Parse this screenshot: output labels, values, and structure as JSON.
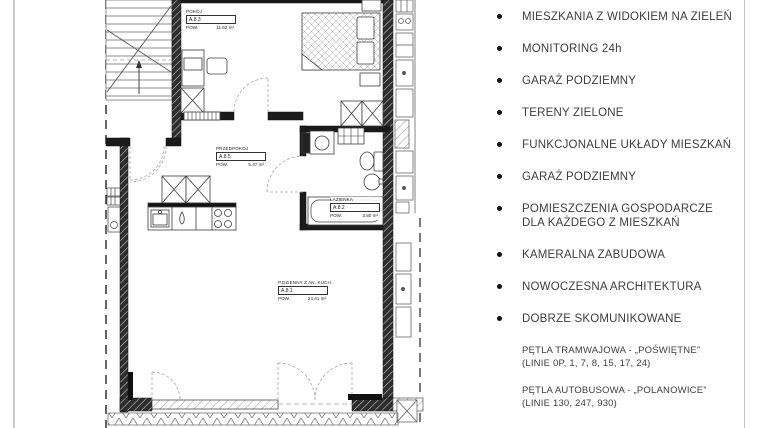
{
  "page": {
    "background": "#ffffff",
    "divider_color": "#c4c4c4",
    "wall_color": "#1b1b1b"
  },
  "floor_plan": {
    "rooms": [
      {
        "name": "POKÓJ",
        "code": "A.8.3",
        "area_label": "POW.",
        "area": "11.62 m²"
      },
      {
        "name": "PRZEDPOKÓJ",
        "code": "A.8.5",
        "area_label": "POW.",
        "area": "5.47 m²"
      },
      {
        "name": "ŁAZIENKA",
        "code": "A.8.2",
        "area_label": "POW.",
        "area": "3.80 m²"
      },
      {
        "name": "P.DZIENNY Z AN. KUCH.",
        "code": "A.8.1",
        "area_label": "POW.",
        "area": "24.41 m²"
      }
    ]
  },
  "features": {
    "items": [
      {
        "label": "MIESZKANIA Z WIDOKIEM NA ZIELEŃ"
      },
      {
        "label": "MONITORING 24h"
      },
      {
        "label": "GARAŻ PODZIEMNY"
      },
      {
        "label": "TERENY ZIELONE"
      },
      {
        "label": "FUNKCJONALNE UKŁADY MIESZKAŃ"
      },
      {
        "label": "GARAŻ PODZIEMNY"
      },
      {
        "label": "POMIESZCZENIA GOSPODARCZE",
        "label2": "DLA KAŻDEGO Z MIESZKAŃ"
      },
      {
        "label": "KAMERALNA ZABUDOWA"
      },
      {
        "label": "NOWOCZESNA ARCHITEKTURA"
      },
      {
        "label": "DOBRZE SKOMUNIKOWANE"
      }
    ]
  },
  "transport": {
    "notes": [
      {
        "line1": "PĘTLA TRAMWAJOWA - „POŚWIĘTNE”",
        "line2": "(LINIE 0P, 1, 7, 8, 15, 17, 24)"
      },
      {
        "line1": "PĘTLA AUTOBUSOWA - „POLANOWICE”",
        "line2": "(LINIE 130, 247, 930)"
      }
    ]
  }
}
